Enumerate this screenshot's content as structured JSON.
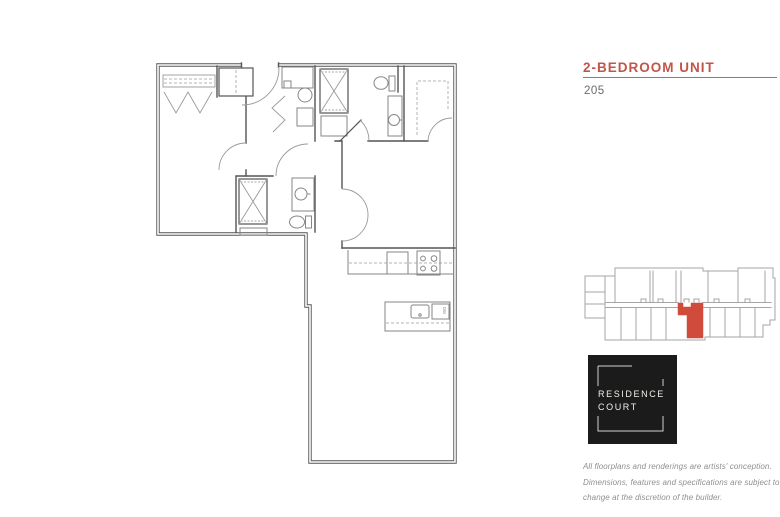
{
  "header": {
    "unit_type": "2-BEDROOM UNIT",
    "unit_number": "205"
  },
  "logo": {
    "line1": "RESIDENCE",
    "line2": "COURT"
  },
  "disclaimer": {
    "lines": [
      "All floorplans and renderings are artists' conception.",
      "Dimensions, features and specifications are subject to",
      "change at the discretion of the builder."
    ]
  },
  "keyplan": {
    "highlighted_unit": "205"
  },
  "colors": {
    "accent": "#c3544a",
    "rule": "#b06b5c",
    "plan_wall": "#545454",
    "keyplan_outline": "#a5a5a5",
    "keyplan_highlight": "#d14b3c",
    "logo_bg": "#1b1b1b",
    "logo_text": "#f2efe9"
  }
}
